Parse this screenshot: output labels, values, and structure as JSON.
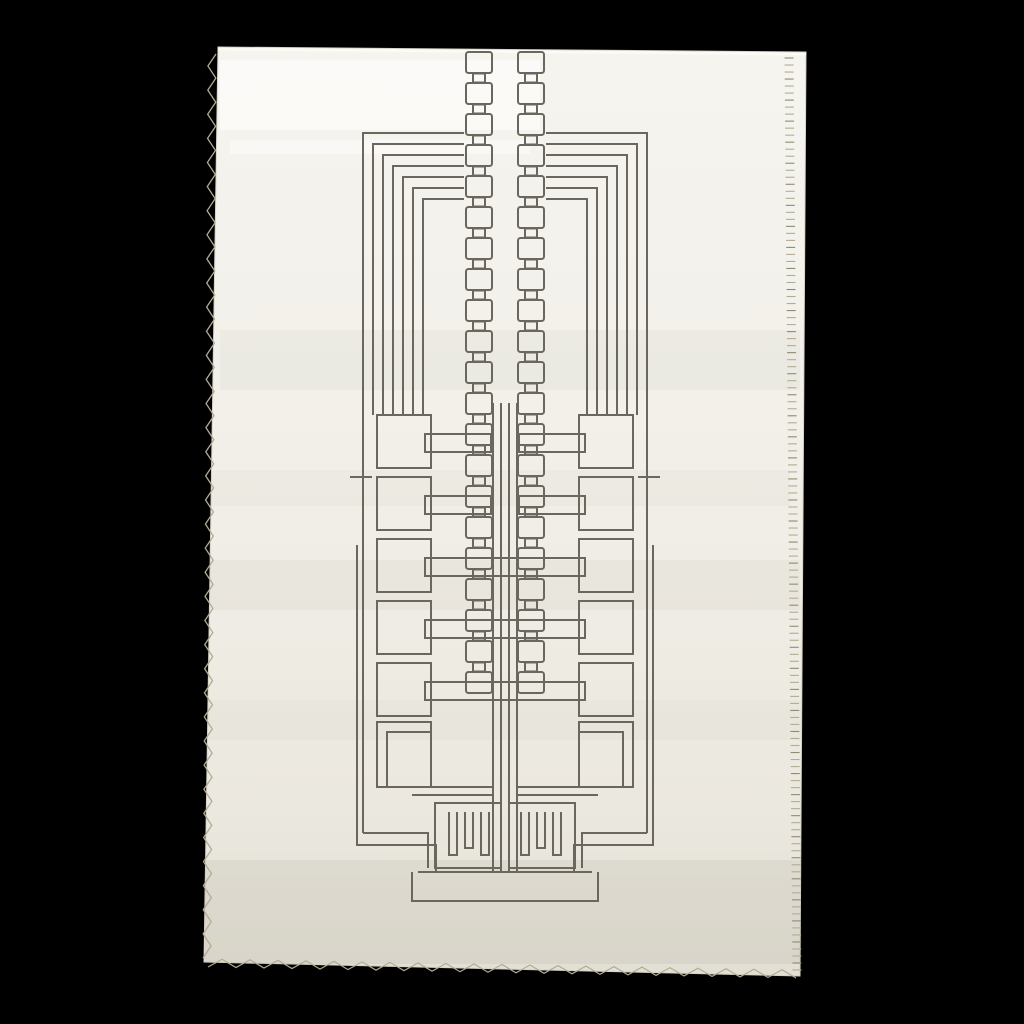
{
  "scene": {
    "background": "#000000",
    "width": 1024,
    "height": 1024
  },
  "fabric": {
    "fill_top": "#f6f4ef",
    "fill_mid": "#f1efe8",
    "fill_low": "#ebe8df",
    "fill_bottom": "#e2dfd4",
    "edge_color": "#d6d2c4",
    "corners": [
      [
        218,
        47
      ],
      [
        806,
        52
      ],
      [
        800,
        976
      ],
      [
        204,
        962
      ]
    ],
    "top_highlight_color": "#fbfaf5",
    "streaks": [
      {
        "x": 220,
        "y": 60,
        "w": 320,
        "h": 70,
        "color": "#ffffff",
        "opacity": 0.55
      },
      {
        "x": 230,
        "y": 140,
        "w": 300,
        "h": 14,
        "color": "#ffffff",
        "opacity": 0.45
      },
      {
        "x": 220,
        "y": 330,
        "w": 580,
        "h": 60,
        "color": "#c9c4b4",
        "opacity": 0.14
      },
      {
        "x": 210,
        "y": 470,
        "w": 580,
        "h": 36,
        "color": "#c9c4b4",
        "opacity": 0.1
      },
      {
        "x": 210,
        "y": 560,
        "w": 590,
        "h": 50,
        "color": "#bdb8a8",
        "opacity": 0.12
      },
      {
        "x": 205,
        "y": 700,
        "w": 600,
        "h": 40,
        "color": "#c9c4b4",
        "opacity": 0.1
      },
      {
        "x": 205,
        "y": 860,
        "w": 600,
        "h": 70,
        "color": "#aaa494",
        "opacity": 0.16
      },
      {
        "x": 205,
        "y": 930,
        "w": 600,
        "h": 34,
        "color": "#9a9484",
        "opacity": 0.14
      }
    ]
  },
  "stitches": {
    "thread_color": "#b3ac94",
    "tick_color": "#8f8a74",
    "left_edge": {
      "x1": 212,
      "y1": 54,
      "x2": 207,
      "y2": 958,
      "period": 12,
      "amplitude": 4
    },
    "right_edge": {
      "x1": 789,
      "y1": 58,
      "x2": 797,
      "y2": 970,
      "period": 7,
      "tick_len": 9
    },
    "bottom_edge": {
      "x1": 208,
      "y1": 963,
      "x2": 796,
      "y2": 974,
      "period": 14,
      "amplitude": 4
    }
  },
  "design": {
    "name": "wright-tower-textile-print",
    "stroke": "#6b675f",
    "stroke_width": 2,
    "cx": 505,
    "chain": {
      "left_box_x": 466,
      "box_w": 26,
      "box_h": 21,
      "box_rx": 2.5,
      "conn_w": 12,
      "conn_h": 9,
      "period": 31,
      "y_start": 52,
      "count": 21
    },
    "staples": {
      "inner_x": 464,
      "items": [
        {
          "x": 363,
          "y_top": 133,
          "y_bottom": 833
        },
        {
          "x": 373,
          "y_top": 144,
          "y_bottom": 415
        },
        {
          "x": 383,
          "y_top": 155,
          "y_bottom": 415
        },
        {
          "x": 393,
          "y_top": 166,
          "y_bottom": 415
        },
        {
          "x": 403,
          "y_top": 177,
          "y_bottom": 415
        },
        {
          "x": 413,
          "y_top": 188,
          "y_bottom": 415
        },
        {
          "x": 423,
          "y_top": 199,
          "y_bottom": 415
        }
      ]
    },
    "outer_line2": {
      "x": 357,
      "y1": 545,
      "y2": 845
    },
    "side_squares": {
      "x": 377,
      "w": 54,
      "h": 53,
      "ys": [
        415,
        477,
        539,
        601,
        663
      ]
    },
    "bars": {
      "x": 425,
      "w_full": 160,
      "w_split": 66,
      "h": 18,
      "items": [
        {
          "y": 434,
          "type": "split"
        },
        {
          "y": 496,
          "type": "split"
        },
        {
          "y": 558,
          "type": "full"
        },
        {
          "y": 620,
          "type": "full"
        },
        {
          "y": 682,
          "type": "full"
        }
      ]
    },
    "dash": {
      "x1": 350,
      "x2": 372,
      "y": 477
    },
    "trunk": {
      "xs": [
        493,
        501,
        509,
        517
      ],
      "y1": 403,
      "y2": 872
    },
    "wing": {
      "outer": [
        377,
        722,
        54,
        65
      ],
      "inner": [
        387,
        732,
        44,
        55
      ]
    },
    "wing_links": [
      {
        "x1": 431,
        "y1": 787,
        "x2": 493,
        "y2": 787
      },
      {
        "x1": 412,
        "y1": 795,
        "x2": 493,
        "y2": 795
      }
    ],
    "base_steps": [
      [
        [
          357,
          545
        ],
        [
          357,
          845
        ],
        [
          436,
          845
        ],
        [
          436,
          872
        ]
      ],
      [
        [
          363,
          833
        ],
        [
          428,
          833
        ],
        [
          428,
          868
        ]
      ]
    ],
    "plate_line": {
      "x1": 418,
      "y1": 872,
      "x2": 592,
      "y2": 872
    },
    "plinth": [
      [
        412,
        872
      ],
      [
        412,
        901
      ],
      [
        598,
        901
      ],
      [
        598,
        872
      ]
    ],
    "comb": {
      "box": [
        435,
        803,
        66,
        65
      ],
      "prong_w": 8,
      "prong_y_top": 812,
      "prong_xs": [
        449,
        465,
        481
      ],
      "prong_y_bottoms": [
        855,
        848,
        855
      ]
    }
  }
}
